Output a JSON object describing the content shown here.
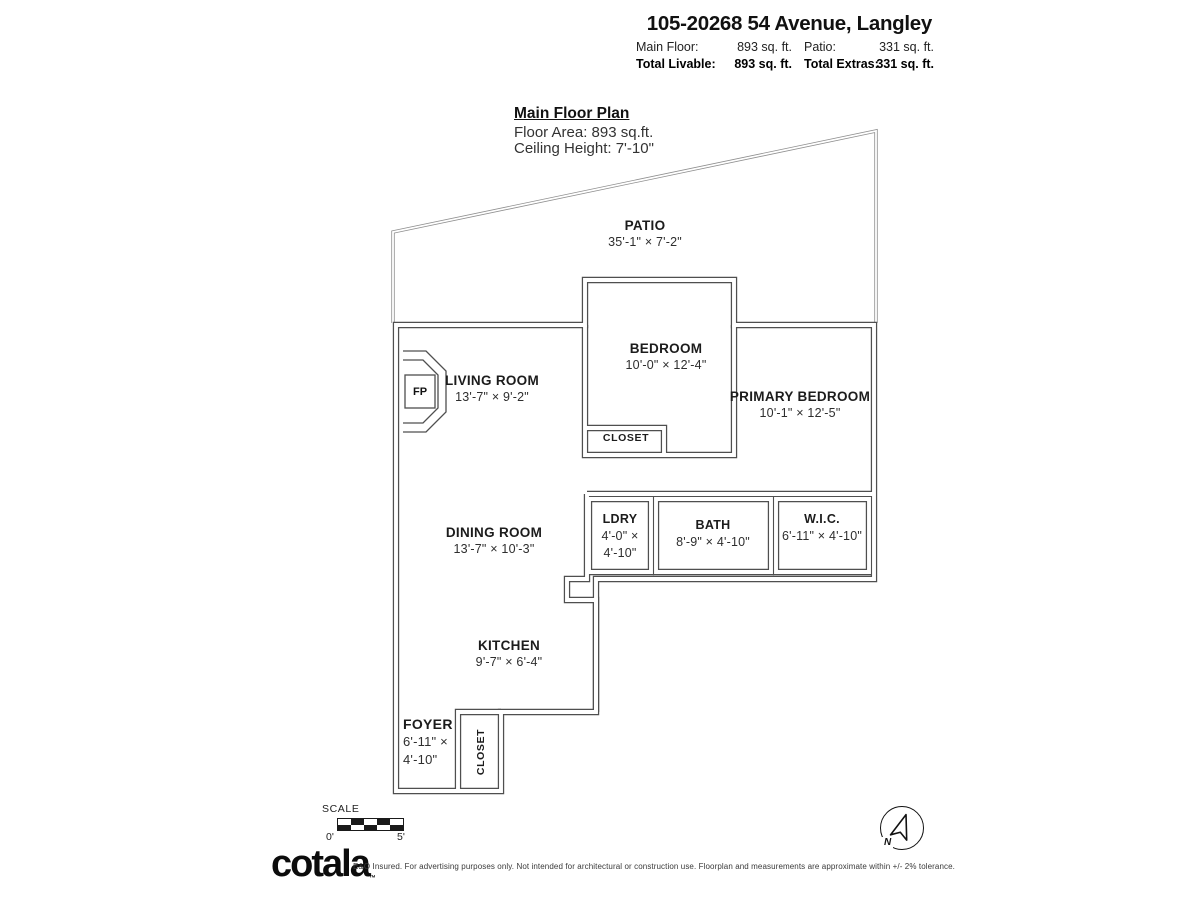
{
  "header": {
    "title": "105-20268 54 Avenue, Langley",
    "stats": {
      "main_floor_label": "Main Floor:",
      "main_floor_value": "893 sq. ft.",
      "patio_label": "Patio:",
      "patio_value": "331 sq. ft.",
      "total_livable_label": "Total Livable:",
      "total_livable_value": "893 sq. ft.",
      "total_extras_label": "Total Extras:",
      "total_extras_value": "331 sq. ft."
    }
  },
  "plan_header": {
    "title": "Main Floor Plan",
    "floor_area": "Floor Area: 893 sq.ft.",
    "ceiling_height": "Ceiling Height: 7'-10\""
  },
  "rooms": {
    "patio": {
      "name": "PATIO",
      "dims": "35'-1\" ×  7'-2\""
    },
    "living_room": {
      "name": "LIVING ROOM",
      "dims": "13'-7\" ×  9'-2\""
    },
    "bedroom": {
      "name": "BEDROOM",
      "dims": "10'-0\" × 12'-4\""
    },
    "bedroom_closet": {
      "name": "CLOSET"
    },
    "primary_bedroom": {
      "name": "PRIMARY BEDROOM",
      "dims": "10'-1\" × 12'-5\""
    },
    "laundry": {
      "name": "LDRY",
      "dims_line1": "4'-0\" ×",
      "dims_line2": "4'-10\""
    },
    "bath": {
      "name": "BATH",
      "dims": "8'-9\" × 4'-10\""
    },
    "wic": {
      "name": "W.I.C.",
      "dims": "6'-11\" × 4'-10\""
    },
    "dining_room": {
      "name": "DINING ROOM",
      "dims": "13'-7\" × 10'-3\""
    },
    "kitchen": {
      "name": "KITCHEN",
      "dims": "9'-7\" × 6'-4\""
    },
    "foyer": {
      "name": "FOYER",
      "dims_line1": "6'-11\" ×",
      "dims_line2": "4'-10\""
    },
    "foyer_closet": {
      "name": "CLOSET"
    }
  },
  "fireplace_label": "FP",
  "scale_bar": {
    "label": "SCALE",
    "start": "0'",
    "end": "5'"
  },
  "compass": {
    "north_label": "N"
  },
  "colors": {
    "wall": "#4f4f4f",
    "patio_line": "#8f8f8f",
    "text": "#1a1a1a"
  },
  "footer": {
    "logo": "cotala",
    "trademark": "™",
    "disclaimer": "E&O Insured. For advertising purposes only. Not intended for architectural or construction use. Floorplan and measurements are approximate within +/- 2% tolerance."
  }
}
